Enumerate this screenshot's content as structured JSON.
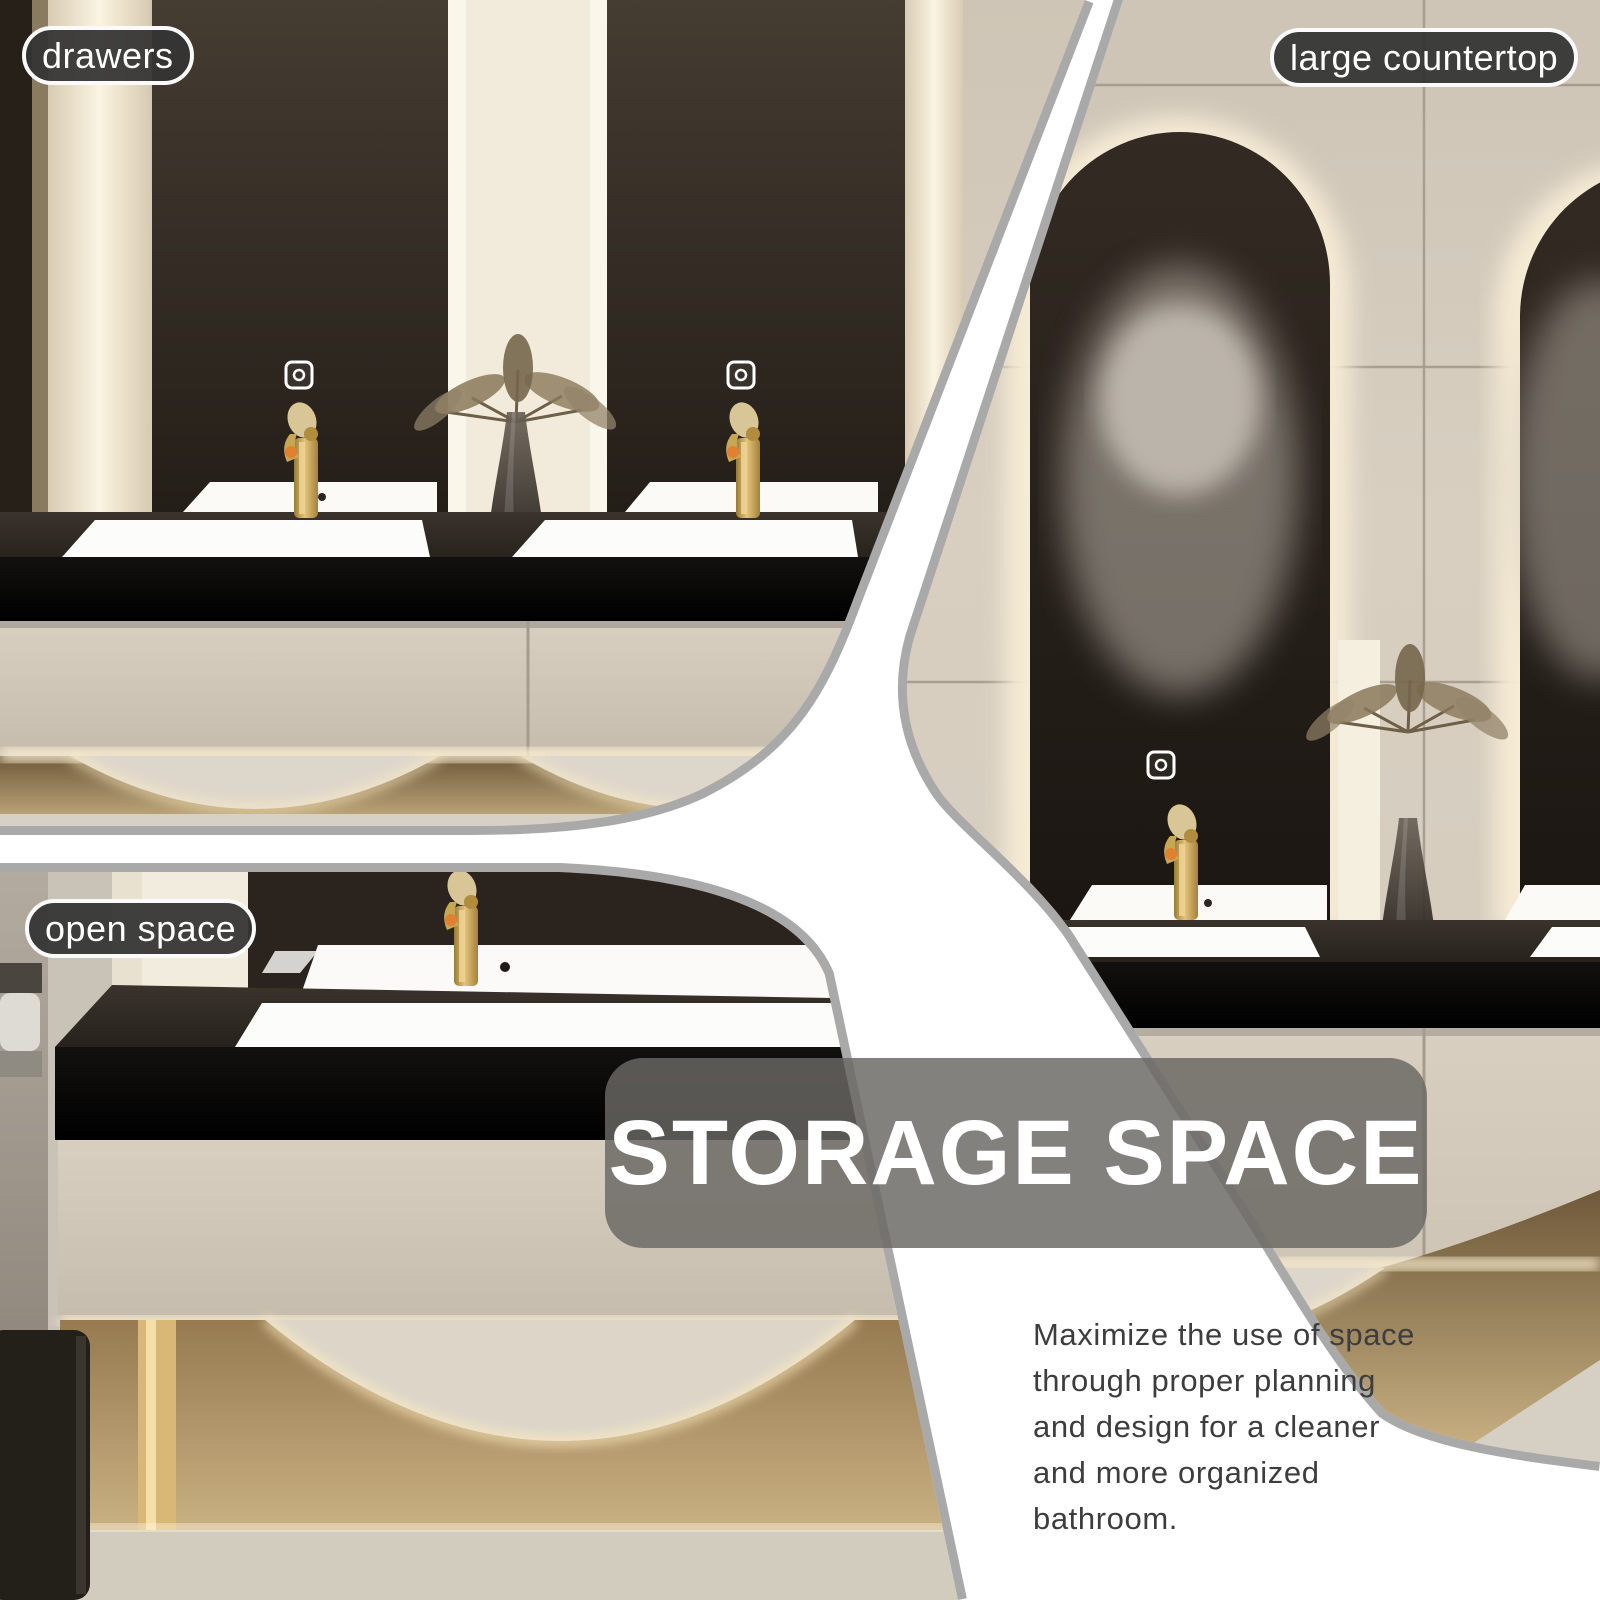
{
  "page": {
    "width": 1600,
    "height": 1600,
    "background": "#ffffff"
  },
  "callouts": {
    "drawers": {
      "label": "drawers"
    },
    "large_countertop": {
      "label": "large countertop"
    },
    "open_space": {
      "label": "open space"
    }
  },
  "overlay": {
    "title": "STORAGE SPACE",
    "paragraph": "Maximize the use of space through proper planning and design for a cleaner and more organized bathroom.",
    "paragraph_lines": [
      "Maximize the use of space",
      "through proper planning",
      "and design for a cleaner",
      "and more organized",
      "bathroom."
    ]
  },
  "icons": {
    "mirror_switch": "touch-switch-icon"
  },
  "colors": {
    "divider_edge_gray": "#a9a9a9",
    "divider_band_white": "#ffffff",
    "label_bg": "rgba(52,52,52,0.94)",
    "label_border": "#fafafa",
    "label_text": "#ffffff",
    "title_box_bg": "rgba(106,103,100,0.83)",
    "title_text": "#ffffff",
    "paragraph_text": "#3d3d3d",
    "wall_beige": "#d6cdbf",
    "mirror_dark_brown": "#2b241e",
    "counter_black": "#1c1814",
    "drawer_beige": "#d2c8ba",
    "gold_accent": "#c9a84e",
    "bronze_glow": "#c9b183",
    "backlight_cream": "#f7eed8"
  }
}
